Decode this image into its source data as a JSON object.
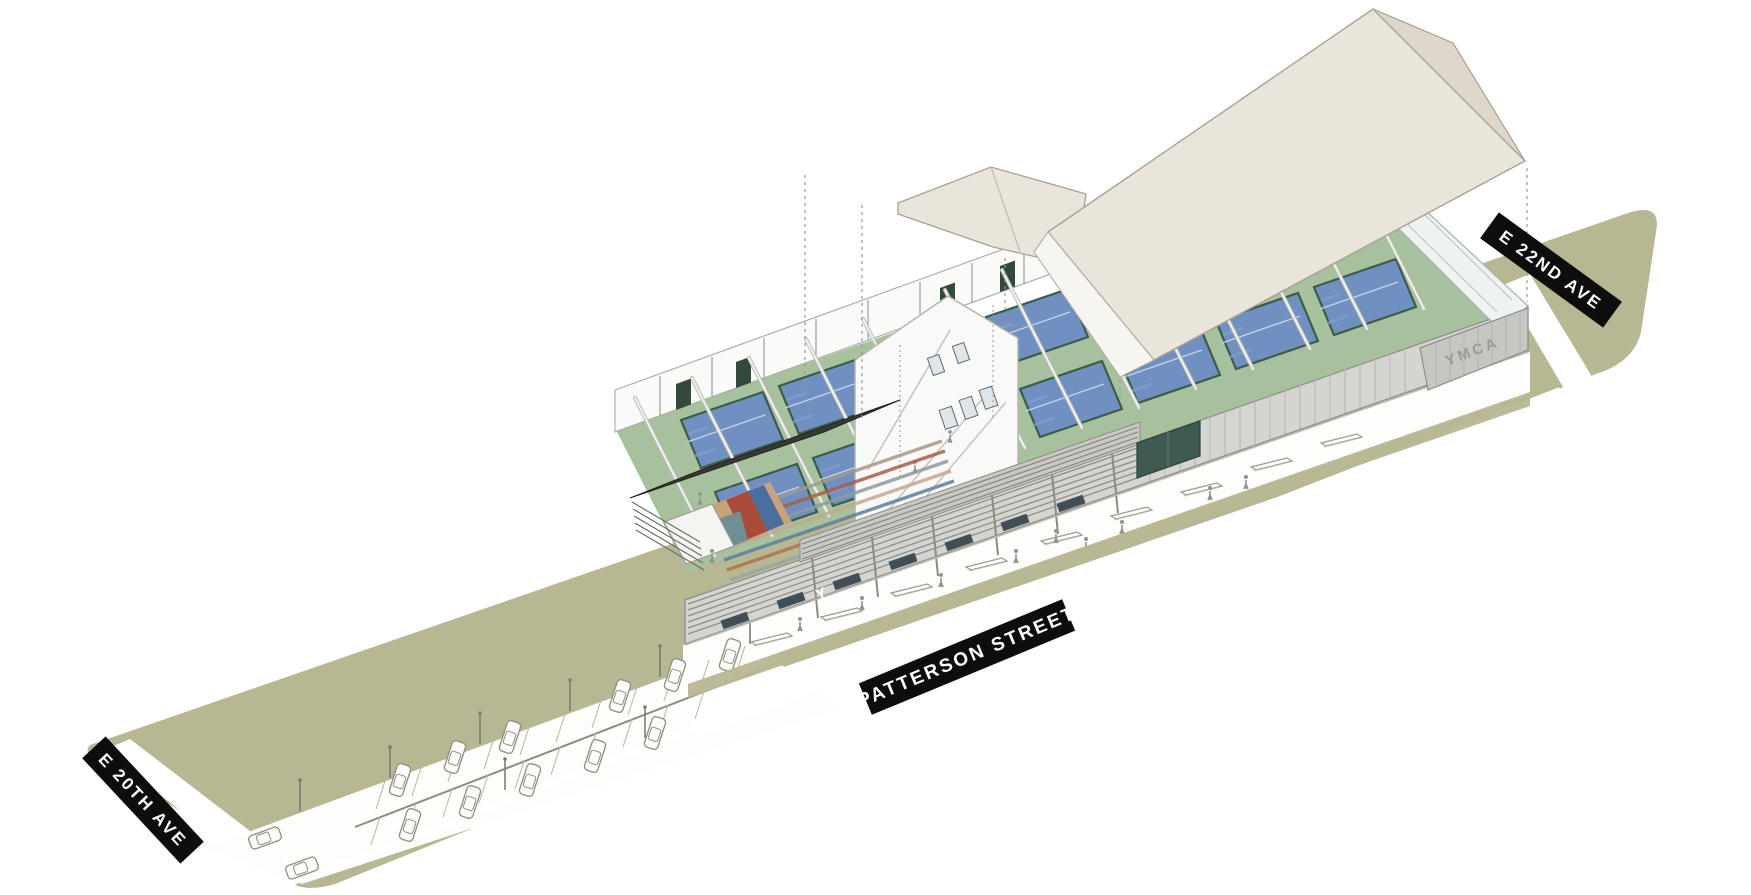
{
  "scene": {
    "streets": {
      "top_right": "E 22ND AVE",
      "front": "PATTERSON STREET",
      "bottom_left": "E 20TH AVE"
    },
    "building": {
      "sign": "YMCA",
      "logo": "Y"
    },
    "colors": {
      "lawn": "#b7b793",
      "court_floor": "#a8c19d",
      "court_blue": "#6f90c1",
      "court_blue_light": "#82a0cd",
      "court_line_green": "#3a5c48",
      "roof_beige": "#eae5db",
      "roof_beige_dark": "#ddd6c9",
      "facade_grey": "#cfcfca",
      "canopy_dark": "#3a3a36",
      "banner_bg": "#0d0d0d",
      "banner_text": "#ffffff",
      "sign_grey": "#979c99"
    }
  }
}
